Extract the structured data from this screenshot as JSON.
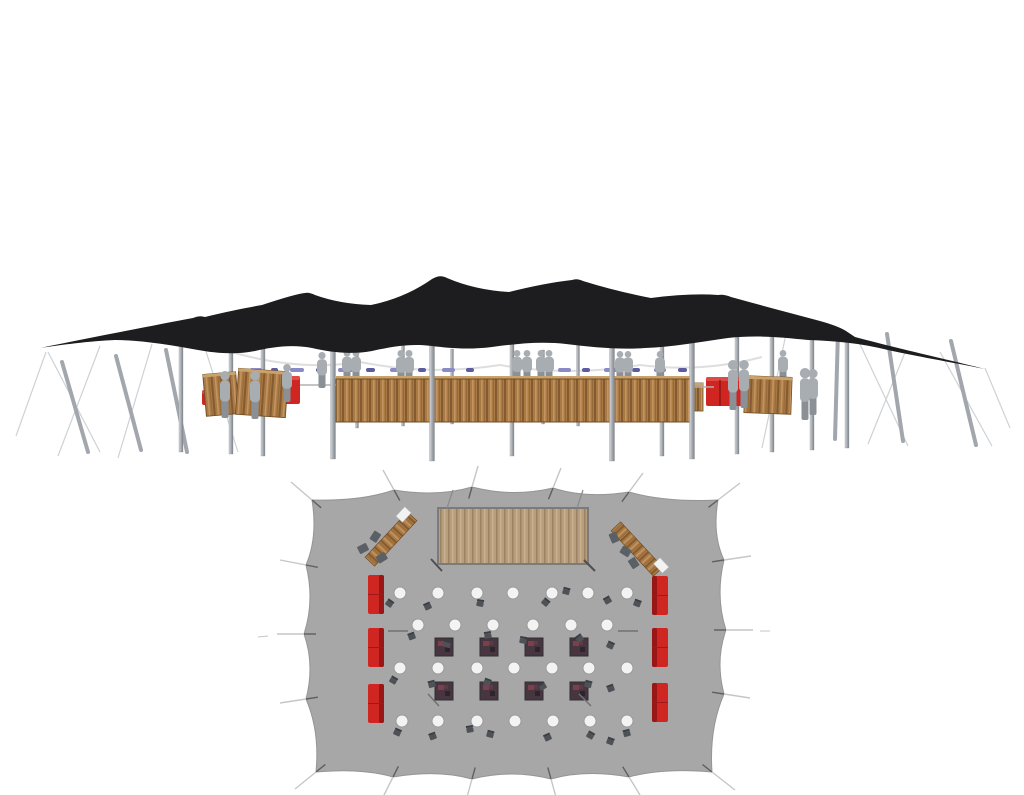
{
  "page": {
    "background": "#ffffff",
    "description": "3D elevation render of a black stretch tent with wooden bar, staff figures and red sofas, above a top-down floor plan of the same tent showing wooden deck, corner bars, cocktail tables, square tables and red sofas"
  },
  "colors": {
    "canopy": "#1d1d1f",
    "canvas": "#a7a7a7",
    "canvas_stroke": "#959595",
    "guy_dark": "#5f5f5f",
    "guy_light": "#c6c6c6",
    "rope": "#cdd2d6",
    "pole_light": "#d6dade",
    "pole_mid": "#a2a7ad",
    "pole_dark": "#7f858c",
    "wood_base": "#a97a43",
    "wood_dark": "#845a30",
    "wood_light": "#c39461",
    "wood_lip": "#c9a36b",
    "wood_stroke": "#6f4c26",
    "deck_base": "#b89e7c",
    "deck_dark": "#9d8365",
    "deck_light": "#c9b190",
    "deck_stroke": "#7b7b7b",
    "red": "#d02622",
    "red_dark": "#8e1414",
    "red_hi": "#e04a44",
    "person": "#a8adb2",
    "person_dark": "#8b9096",
    "table_fill": "#f3f3f3",
    "table_stroke": "#9a9a9a",
    "chair": "#4e5257",
    "chair_dark": "#3a3e42",
    "square_fill": "#473640",
    "square_stroke": "#2f2f34",
    "square_fleck1": "#7a404b",
    "square_fleck2": "#2c2430",
    "square_fleck3": "#5d3a44",
    "bunting_a": "#8a8ac6",
    "bunting_b": "#5c5ca0",
    "arc": "#dedede",
    "white_item": "#f2f2f2",
    "blob": "#5b6066",
    "mark": "#4f4f4f"
  },
  "elevation": {
    "canopy_d": "M40,348 C90,338 150,326 193,318 Q199,315 205,317 C225,312 245,308 262,305 Q295,294 305,293 Q309,292 315,295 Q340,304 371,305 Q405,298 432,279 Q440,274 447,278 Q475,290 509,292 Q545,283 572,280 Q577,278 583,281 Q615,291 651,298 Q690,293 718,295 Q724,294 731,297 Q760,305 790,313 L820,321 Q838,326 846,331 L855,337 C900,349 950,360 985,369 C950,362 915,356 888,350 C860,343 835,341 808,340 C780,337 755,335 728,338 C700,342 672,347 645,348 C618,350 592,347 566,344 C540,341 515,344 492,347 C468,350 448,348 432,346 C410,343 390,347 372,351 C350,355 330,352 312,348 C292,344 272,347 255,351 C235,355 215,353 198,350 C170,345 140,340 115,340 C90,341 60,345 40,348 Z",
    "arc_d": "M225,350 Q295,372 360,362 Q430,376 500,365 Q570,377 640,365 Q702,373 762,357",
    "ropes": [
      [
        46,
        352,
        16,
        436
      ],
      [
        48,
        352,
        100,
        452
      ],
      [
        100,
        346,
        58,
        456
      ],
      [
        152,
        344,
        118,
        458
      ],
      [
        196,
        320,
        238,
        452
      ],
      [
        906,
        350,
        868,
        444
      ],
      [
        940,
        352,
        992,
        446
      ],
      [
        985,
        368,
        1010,
        428
      ],
      [
        858,
        340,
        908,
        446
      ],
      [
        790,
        315,
        762,
        448
      ]
    ],
    "poles_leaning": [
      [
        62,
        362,
        88,
        452
      ],
      [
        116,
        356,
        141,
        450
      ],
      [
        166,
        350,
        187,
        452
      ],
      [
        838,
        331,
        835,
        439
      ],
      [
        887,
        334,
        903,
        441
      ],
      [
        951,
        341,
        976,
        445
      ]
    ],
    "poles_back": [
      [
        181,
        330,
        452,
        4
      ],
      [
        231,
        320,
        454,
        4
      ],
      [
        263,
        343,
        456,
        4
      ],
      [
        357,
        350,
        428,
        3
      ],
      [
        403,
        338,
        426,
        3
      ],
      [
        452,
        349,
        424,
        3
      ],
      [
        512,
        316,
        456,
        4
      ],
      [
        543,
        350,
        424,
        3
      ],
      [
        578,
        328,
        426,
        3
      ],
      [
        662,
        328,
        456,
        4
      ],
      [
        737,
        320,
        454,
        4
      ],
      [
        772,
        328,
        452,
        4
      ],
      [
        812,
        333,
        450,
        4
      ],
      [
        847,
        336,
        448,
        4
      ]
    ],
    "poles_front": [
      [
        333,
        328,
        459,
        5
      ],
      [
        432,
        296,
        461,
        5
      ],
      [
        612,
        298,
        461,
        5
      ],
      [
        692,
        316,
        459,
        5
      ]
    ],
    "bunting_y": 368,
    "bunting": [
      [
        250,
        12,
        "a"
      ],
      [
        271,
        7,
        "b"
      ],
      [
        290,
        14,
        "a"
      ],
      [
        316,
        8,
        "b"
      ],
      [
        338,
        15,
        "a"
      ],
      [
        366,
        9,
        "b"
      ],
      [
        390,
        13,
        "a"
      ],
      [
        418,
        8,
        "b"
      ],
      [
        442,
        13,
        "a"
      ],
      [
        466,
        8,
        "b"
      ],
      [
        558,
        13,
        "a"
      ],
      [
        582,
        8,
        "b"
      ],
      [
        604,
        14,
        "a"
      ],
      [
        632,
        8,
        "b"
      ],
      [
        654,
        12,
        "a"
      ],
      [
        678,
        9,
        "b"
      ]
    ],
    "people_back": [
      [
        347,
        384,
        34
      ],
      [
        356,
        384,
        34
      ],
      [
        401,
        385,
        35
      ],
      [
        409,
        385,
        35
      ],
      [
        517,
        384,
        34
      ],
      [
        527,
        384,
        34
      ],
      [
        541,
        384,
        34
      ],
      [
        549,
        384,
        34
      ],
      [
        620,
        384,
        33
      ],
      [
        628,
        384,
        33
      ],
      [
        660,
        384,
        33
      ],
      [
        783,
        384,
        34
      ]
    ],
    "people_front": [
      [
        225,
        418,
        47
      ],
      [
        255,
        419,
        48
      ],
      [
        287,
        402,
        38
      ],
      [
        322,
        388,
        36
      ],
      [
        733,
        410,
        50
      ],
      [
        744,
        408,
        48
      ],
      [
        805,
        420,
        52
      ],
      [
        813,
        415,
        46
      ]
    ],
    "sofas": [
      [
        202,
        390,
        11,
        15
      ],
      [
        284,
        376,
        16,
        28
      ],
      [
        706,
        377,
        42,
        29
      ]
    ],
    "cabinets": [
      [
        221,
        394,
        33,
        42,
        -5
      ],
      [
        262,
        393,
        50,
        46,
        4
      ],
      [
        768,
        395,
        47,
        37,
        2
      ],
      [
        697,
        397,
        12,
        28,
        0
      ]
    ],
    "bar": [
      336,
      379,
      358,
      43
    ],
    "lines": [
      [
        300,
        385,
        336,
        385
      ],
      [
        694,
        387,
        714,
        387
      ]
    ]
  },
  "plan": {
    "center": [
      515,
      632
    ],
    "sag": 10,
    "outline": [
      [
        312,
        500
      ],
      [
        394,
        490
      ],
      [
        472,
        487
      ],
      [
        553,
        488
      ],
      [
        629,
        492
      ],
      [
        718,
        500
      ],
      [
        724,
        560
      ],
      [
        726,
        630
      ],
      [
        724,
        694
      ],
      [
        712,
        772
      ],
      [
        629,
        777
      ],
      [
        551,
        779
      ],
      [
        472,
        779
      ],
      [
        393,
        777
      ],
      [
        316,
        772
      ],
      [
        306,
        699
      ],
      [
        304,
        634
      ],
      [
        306,
        565
      ]
    ],
    "guys": [
      [
        312,
        500,
        291,
        482
      ],
      [
        394,
        490,
        383,
        470
      ],
      [
        472,
        487,
        478,
        466
      ],
      [
        553,
        488,
        561,
        468
      ],
      [
        629,
        492,
        643,
        473
      ],
      [
        718,
        500,
        740,
        483
      ],
      [
        724,
        560,
        751,
        556
      ],
      [
        726,
        630,
        753,
        630
      ],
      [
        724,
        694,
        750,
        698
      ],
      [
        712,
        772,
        735,
        790
      ],
      [
        629,
        777,
        640,
        795
      ],
      [
        551,
        779,
        556,
        797
      ],
      [
        472,
        779,
        467,
        797
      ],
      [
        393,
        777,
        384,
        795
      ],
      [
        316,
        772,
        295,
        789
      ],
      [
        306,
        699,
        280,
        703
      ],
      [
        304,
        634,
        277,
        634
      ],
      [
        306,
        565,
        280,
        560
      ]
    ],
    "stakes": [
      [
        258,
        637,
        268,
        636
      ],
      [
        760,
        631,
        770,
        631
      ],
      [
        381,
        799,
        378,
        807
      ],
      [
        556,
        800,
        556,
        808
      ],
      [
        642,
        798,
        647,
        806
      ],
      [
        466,
        800,
        464,
        808
      ]
    ],
    "deck": [
      438,
      508,
      150,
      56
    ],
    "deck_guys": [
      [
        447,
        508,
        453,
        490
      ],
      [
        577,
        508,
        583,
        490
      ]
    ],
    "deck_ticks": [
      [
        431,
        559,
        442,
        571
      ],
      [
        584,
        560,
        595,
        571
      ]
    ],
    "corner_bars": [
      {
        "cx": 391,
        "cy": 539,
        "rot": -47,
        "white": [
          20,
          -12
        ],
        "blobs": [
          [
            -26,
            -14,
            20
          ],
          [
            -9,
            -13,
            -10
          ],
          [
            -20,
            6,
            15
          ]
        ]
      },
      {
        "cx": 637,
        "cy": 549,
        "rot": 47,
        "white": [
          22,
          -11
        ],
        "blobs": [
          [
            -24,
            9,
            20
          ],
          [
            -6,
            10,
            -15
          ],
          [
            8,
            12,
            10
          ]
        ]
      }
    ],
    "sofa_size": [
      16,
      39
    ],
    "sofas_left": [
      [
        368,
        575
      ],
      [
        368,
        628
      ],
      [
        368,
        684
      ]
    ],
    "sofas_right": [
      [
        652,
        576
      ],
      [
        652,
        628
      ],
      [
        652,
        683
      ]
    ],
    "table_r": 6,
    "table_rows": [
      {
        "y": 593,
        "xs": [
          400,
          438,
          477,
          513,
          552,
          588,
          627
        ]
      },
      {
        "y": 625,
        "xs": [
          418,
          455,
          493,
          533,
          571,
          607
        ]
      },
      {
        "y": 668,
        "xs": [
          400,
          438,
          477,
          514,
          552,
          589,
          627
        ]
      },
      {
        "y": 721,
        "xs": [
          402,
          438,
          477,
          515,
          553,
          590,
          627
        ]
      }
    ],
    "square_size": 18,
    "square_rows": [
      {
        "y": 638,
        "xs": [
          435,
          480,
          525,
          570
        ]
      },
      {
        "y": 682,
        "xs": [
          435,
          480,
          525,
          570
        ]
      }
    ],
    "chairs": [
      [
        389,
        604,
        35
      ],
      [
        428,
        607,
        -25
      ],
      [
        480,
        604,
        10
      ],
      [
        545,
        603,
        40
      ],
      [
        608,
        601,
        -30
      ],
      [
        566,
        592,
        15
      ],
      [
        637,
        604,
        20
      ],
      [
        412,
        637,
        -20
      ],
      [
        447,
        645,
        15
      ],
      [
        523,
        641,
        10
      ],
      [
        580,
        639,
        -35
      ],
      [
        610,
        646,
        25
      ],
      [
        488,
        636,
        -10
      ],
      [
        393,
        681,
        30
      ],
      [
        432,
        685,
        -15
      ],
      [
        487,
        683,
        20
      ],
      [
        543,
        687,
        -30
      ],
      [
        588,
        685,
        15
      ],
      [
        611,
        689,
        -20
      ],
      [
        397,
        733,
        25
      ],
      [
        433,
        737,
        -20
      ],
      [
        490,
        735,
        15
      ],
      [
        548,
        738,
        -25
      ],
      [
        590,
        736,
        30
      ],
      [
        627,
        734,
        -15
      ],
      [
        610,
        742,
        20
      ],
      [
        470,
        730,
        -10
      ]
    ],
    "marks": [
      [
        388,
        631,
        408,
        631
      ],
      [
        618,
        631,
        638,
        631
      ],
      [
        428,
        694,
        439,
        706
      ],
      [
        579,
        694,
        591,
        706
      ]
    ]
  }
}
